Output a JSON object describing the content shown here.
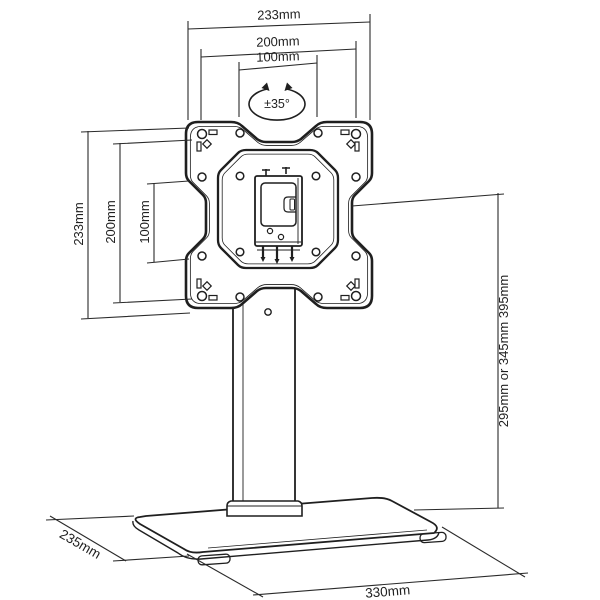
{
  "diagram": {
    "colors": {
      "line": "#1f1f1f",
      "dim_line": "#2a2a2a",
      "background": "#ffffff"
    },
    "labels": {
      "top_width_overall": "233mm",
      "top_width_200": "200mm",
      "top_width_100": "100mm",
      "swivel": "±35°",
      "left_height_overall": "233mm",
      "left_height_200": "200mm",
      "left_height_100": "100mm",
      "pole_height": "295mm or 345mm 395mm",
      "base_depth": "235mm",
      "base_width": "330mm"
    }
  }
}
